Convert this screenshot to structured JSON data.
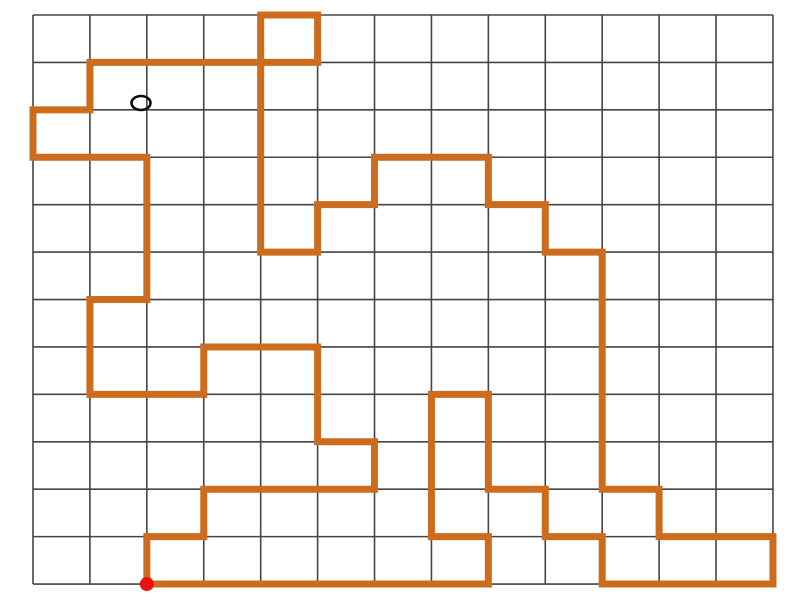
{
  "canvas": {
    "width": 800,
    "height": 600,
    "background": "#ffffff"
  },
  "grid": {
    "left": 33,
    "top": 15,
    "columns": 13,
    "rows": 12,
    "cell_width": 56.92,
    "cell_height": 47.42,
    "line_color": "#454545",
    "line_width": 1.6
  },
  "route": {
    "color": "#cc6c1c",
    "stroke_width": 7,
    "closed": true,
    "vertices": [
      [
        2,
        12
      ],
      [
        2,
        11
      ],
      [
        3,
        11
      ],
      [
        3,
        10
      ],
      [
        6,
        10
      ],
      [
        6,
        9
      ],
      [
        5,
        9
      ],
      [
        5,
        7
      ],
      [
        3,
        7
      ],
      [
        3,
        8
      ],
      [
        1,
        8
      ],
      [
        1,
        6
      ],
      [
        2,
        6
      ],
      [
        2,
        3
      ],
      [
        0,
        3
      ],
      [
        0,
        2
      ],
      [
        1,
        2
      ],
      [
        1,
        1
      ],
      [
        5,
        1
      ],
      [
        5,
        0
      ],
      [
        4,
        0
      ],
      [
        4,
        5
      ],
      [
        5,
        5
      ],
      [
        5,
        4
      ],
      [
        6,
        4
      ],
      [
        6,
        3
      ],
      [
        8,
        3
      ],
      [
        8,
        4
      ],
      [
        9,
        4
      ],
      [
        9,
        5
      ],
      [
        10,
        5
      ],
      [
        10,
        10
      ],
      [
        11,
        10
      ],
      [
        11,
        11
      ],
      [
        13,
        11
      ],
      [
        13,
        12
      ],
      [
        10,
        12
      ],
      [
        10,
        11
      ],
      [
        9,
        11
      ],
      [
        9,
        10
      ],
      [
        8,
        10
      ],
      [
        8,
        8
      ],
      [
        7,
        8
      ],
      [
        7,
        11
      ],
      [
        8,
        11
      ],
      [
        8,
        12
      ]
    ]
  },
  "markers": {
    "ellipse_marker": {
      "cx": 141,
      "cy": 103,
      "rx": 9.5,
      "ry": 7,
      "stroke": "#0d0d0d",
      "stroke_width": 2.6,
      "fill": "none"
    },
    "start_dot": {
      "col": 2,
      "row": 12,
      "radius": 7,
      "color": "#ea1212"
    }
  }
}
